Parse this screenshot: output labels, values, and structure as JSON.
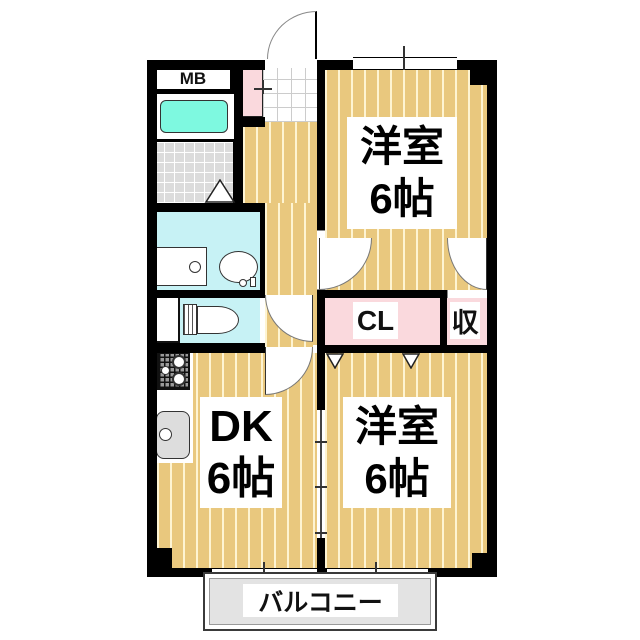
{
  "colors": {
    "wall": "#000000",
    "floor_tan": "#E9C87E",
    "closet_pink": "#FAD9DD",
    "wet_cyan": "#C7F2F5",
    "bathtub_aqua": "#7EF9E0",
    "tile_gray": "#DCDCDC",
    "balcony_gray": "#E3E3E3"
  },
  "rooms": {
    "western_top": {
      "name": "洋室",
      "size": "6帖"
    },
    "western_bottom": {
      "name": "洋室",
      "size": "6帖"
    },
    "dk": {
      "name": "DK",
      "size": "6帖"
    }
  },
  "labels": {
    "meter_box": "MB",
    "closet": "CL",
    "storage": "収",
    "balcony": "バルコニー"
  }
}
